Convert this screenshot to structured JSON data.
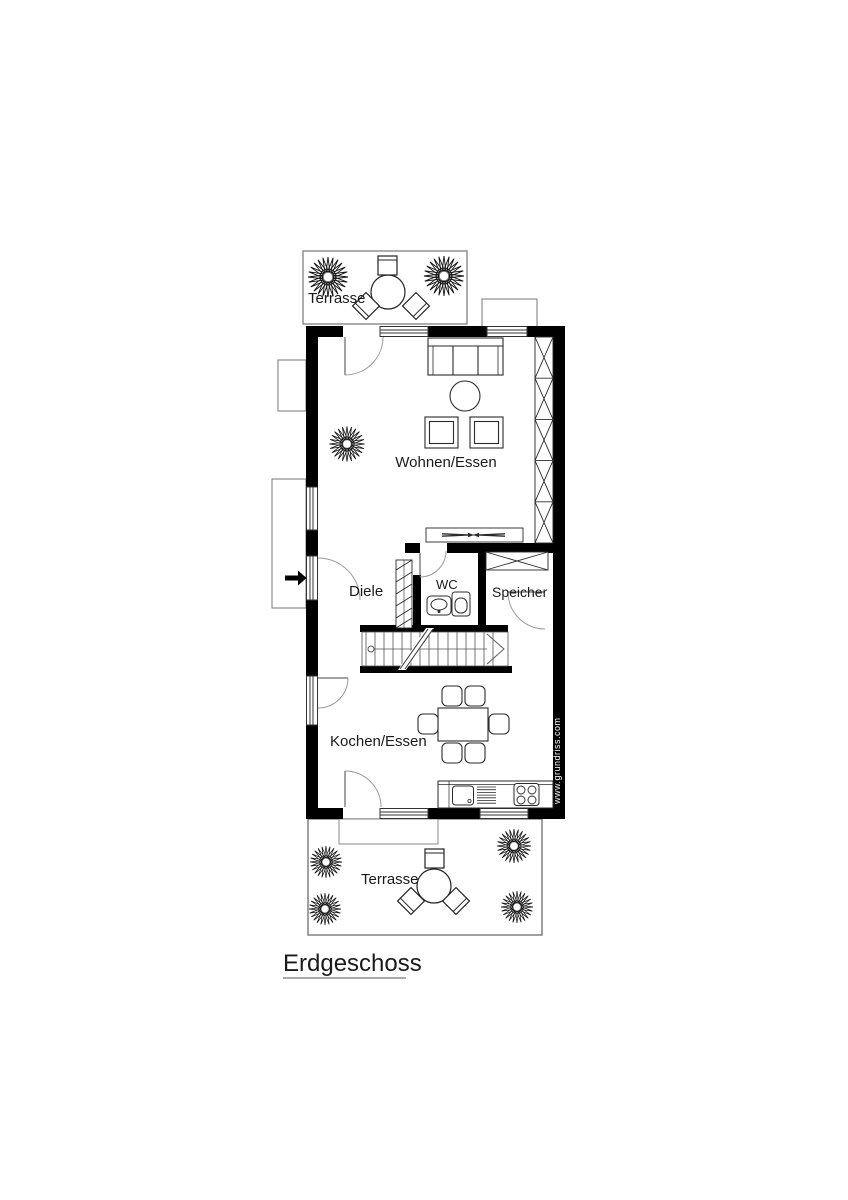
{
  "title": "Erdgeschoss",
  "watermark": "www.grundriss.com",
  "labels": {
    "terrasse_top": "Terrasse",
    "wohnen_essen": "Wohnen/Essen",
    "diele": "Diele",
    "wc": "WC",
    "speicher": "Speicher",
    "kochen_essen": "Kochen/Essen",
    "terrasse_bottom": "Terrasse",
    "floor_title": "Erdgeschoss"
  },
  "colors": {
    "wall": "#000000",
    "furniture_line": "#2a2a2a",
    "door_arc": "#999999",
    "terrace_outline": "#888888",
    "watermark_text": "#ffffff"
  },
  "rooms": [
    {
      "label": "Terrasse",
      "position": "top",
      "icons": [
        "round-table-icon",
        "chair-icon",
        "plant-icon"
      ]
    },
    {
      "label": "Wohnen/Essen",
      "icons": [
        "sofa-icon",
        "side-table-icon",
        "armchair-icon",
        "plant-icon",
        "wardrobe-icon",
        "tv-board-icon"
      ]
    },
    {
      "label": "Diele",
      "icons": [
        "entrance-arrow-icon",
        "coat-rack-icon",
        "door-icon"
      ]
    },
    {
      "label": "WC",
      "icons": [
        "washbasin-icon",
        "toilet-icon",
        "door-icon"
      ]
    },
    {
      "label": "Speicher",
      "icons": [
        "shelf-icon",
        "door-icon"
      ]
    },
    {
      "label": "Kochen/Essen",
      "icons": [
        "dining-table-icon",
        "chair-icon",
        "kitchen-counter-icon",
        "sink-icon",
        "cooktop-icon",
        "stairs-icon"
      ]
    },
    {
      "label": "Terrasse",
      "position": "bottom",
      "icons": [
        "round-table-icon",
        "chair-icon",
        "plant-icon"
      ]
    }
  ]
}
